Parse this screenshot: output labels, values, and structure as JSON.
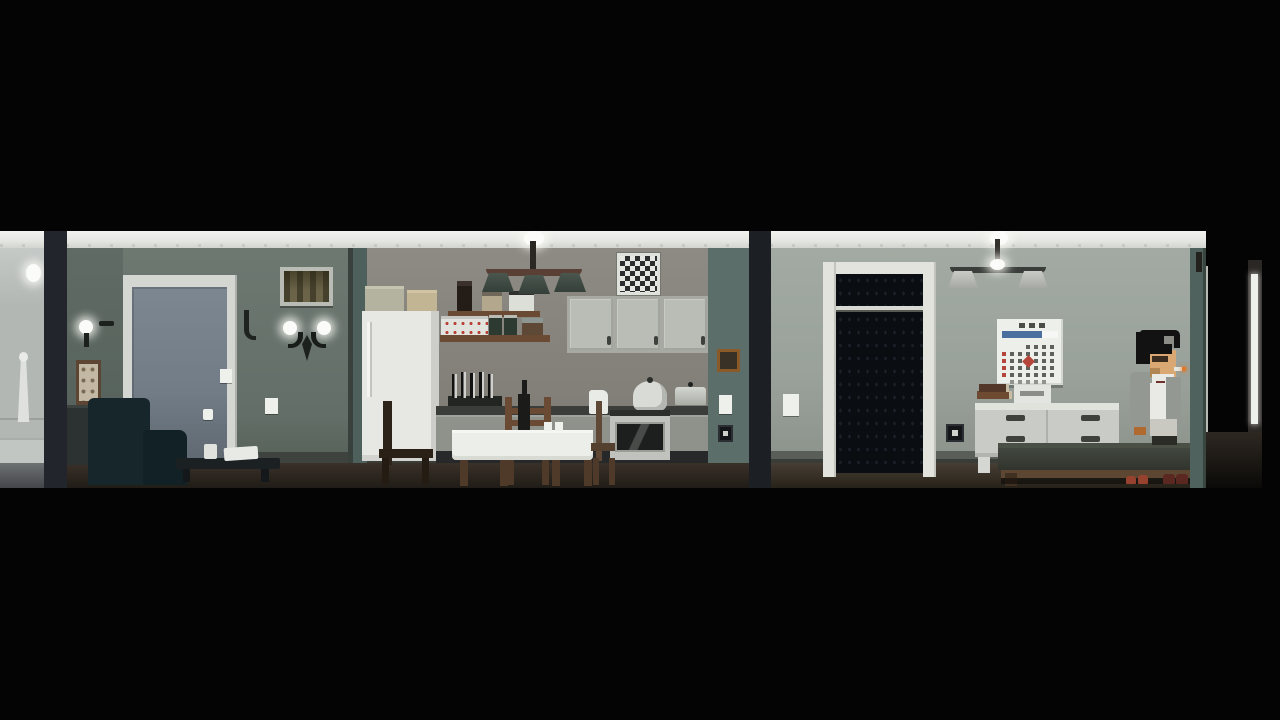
{
  "meta": {
    "type": "game-scene",
    "description": "Side-view pixel-art apartment cross-section, letterboxed by black bars. Left to right: neighbour room with statue, living room with door/armchair/coffee table, kitchen with fridge/shelves/stove/dining table, bedroom with dark closet doorway, wall calendar, dresser, bed, a standing character smoking, and an open exit door.",
    "resolution": "1280x720"
  },
  "palette": {
    "divider": "#22252b",
    "leftroom-wall": "#b2b7b4",
    "living-wall": "#68736d",
    "door-frame": "#d4d7d1",
    "door-panel": "#727c86",
    "picture-frame": "#b9bcb4",
    "armchair": "#16262a",
    "kitchen-wall": "#827f78",
    "teal-strip": "#4e605b",
    "fridge": "#e7e8e4",
    "cabinet": "#babcb6",
    "checker-dark": "#2b2d2e",
    "shade-green": "#333f38",
    "counter": "#3b3d3b",
    "tablecloth": "#eceeea",
    "wood": "#6b4a33",
    "bedroom-wall": "#99a19a",
    "closet-frame": "#e1e3dc",
    "closet-dark": "#0a0e13",
    "calendar-bg": "#edefeb",
    "calendar-blue": "#4a6f9e",
    "calendar-red": "#b5453b",
    "dresser": "#c9cbc6",
    "bed-blanket": "#30342c",
    "bed-wood": "#5e4732",
    "floor-brown": "#3a3129",
    "floor-bedroom": "#473e35",
    "exit-jamb": "#2b2724",
    "char-hair": "#121212",
    "char-skin": "#d9a873",
    "char-jacket": "#949893",
    "char-shirt": "#e9eae5",
    "char-trousers": "#c9c9c2",
    "cigarette-tip": "#e0782a",
    "slipper-red": "#97412f"
  },
  "scene": {
    "regions": [
      "neighbour-room",
      "living-room",
      "kitchen",
      "bedroom",
      "exit-hallway"
    ],
    "objects": [
      "statue",
      "wall-lamp",
      "interior-door",
      "wall-sconce",
      "wall-picture",
      "framed-photo",
      "sideboard",
      "armchair",
      "coffee-table",
      "cup",
      "papers",
      "refrigerator",
      "boxes",
      "wooden-chair",
      "spice-shelves",
      "kitchen-chandelier",
      "checkerboard-frame",
      "upper-cabinets",
      "knife-block",
      "counter",
      "pitcher",
      "stove",
      "kettle",
      "pot",
      "dining-table",
      "ladder-chair",
      "wine-bottle",
      "closet-doorway",
      "closet-rail",
      "light-switch",
      "power-outlet",
      "wall-calendar",
      "book-stack",
      "white-device",
      "dresser",
      "bed",
      "slippers",
      "open-exit-door"
    ],
    "character": {
      "name": "player-character",
      "pose": "standing-facing-right",
      "features": [
        "black-hair",
        "cigarette",
        "gray-jacket",
        "white-shirt",
        "light-trousers"
      ]
    },
    "calendar": {
      "rows": [
        "___dddd",
        "rdddddd",
        "rddxddd",
        "rdddddd",
        "rdddddd",
        "_ggggg_"
      ],
      "colors": {
        "d": "#5f625c",
        "r": "#b5453b",
        "g": "#8f938f",
        "x": "#b5453b"
      }
    }
  }
}
